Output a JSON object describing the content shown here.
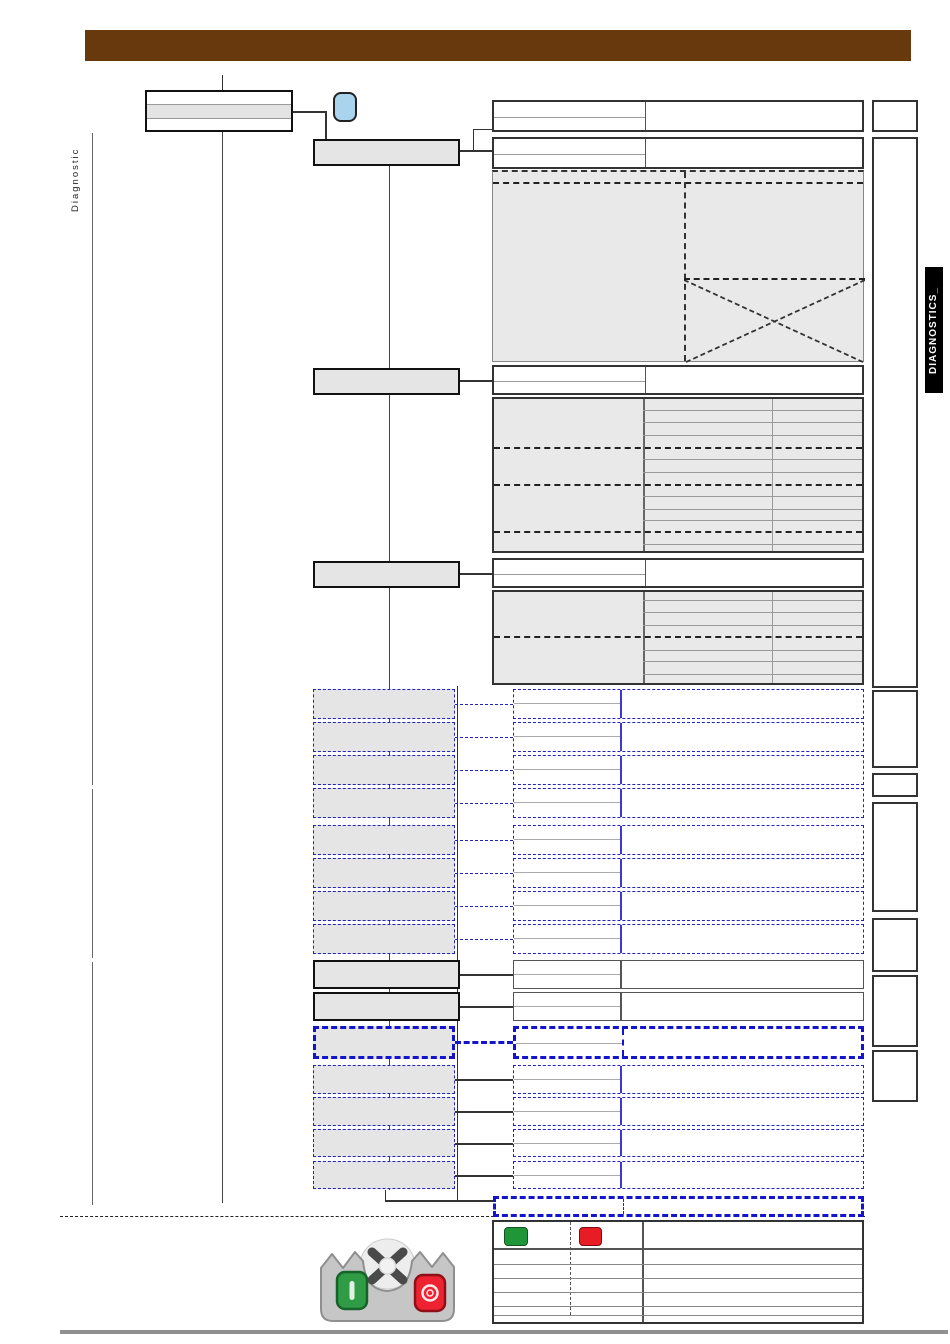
{
  "page": {
    "side_label": "Diagnostic",
    "side_tab": "DIAGNOSTICS_"
  },
  "colors": {
    "header_bar": "#69390e",
    "icon_blue": "#aad3ee",
    "dash_blue": "#2323bb",
    "thick_dash_blue": "#1414cc",
    "legend_green": "#1f9638",
    "legend_red": "#e81c24",
    "box_fill": "#e5e5e5",
    "panel_fill": "#e9e9e9"
  },
  "icons": {
    "tool_icon": "diagnostic-tool",
    "legend_green_icon": "green-start-button",
    "legend_red_icon": "red-stop-button",
    "handset_icon": "diagnostic-handset-with-start-stop-buttons"
  }
}
